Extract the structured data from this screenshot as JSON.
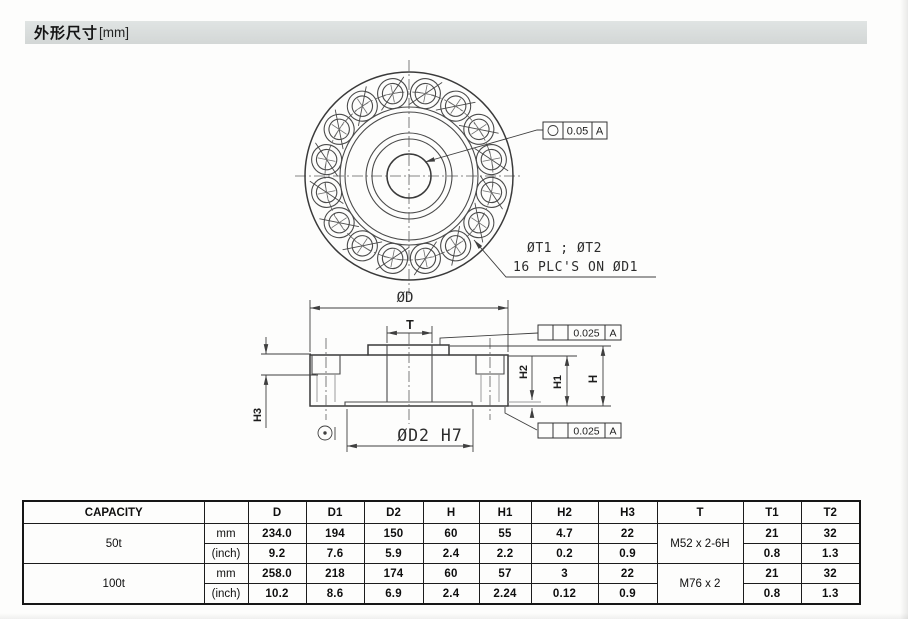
{
  "header": {
    "title": "外形尺寸",
    "unit_suffix": "[mm]"
  },
  "top_view": {
    "tolerance": {
      "symbol": "○",
      "value": "0.05",
      "datum": "A"
    },
    "hole_note_line1": "ØT1 ; ØT2",
    "hole_note_line2": "16 PLC'S ON ØD1"
  },
  "front_view": {
    "labels": {
      "outer_dia": "ØD",
      "thread": "T",
      "h": "H",
      "h1": "H1",
      "h2": "H2",
      "h3": "H3",
      "bore": "ØD2 H7",
      "bore_symbol": "⊙"
    },
    "tolerance_top": {
      "value": "0.025",
      "datum": "A"
    },
    "tolerance_bottom": {
      "value": "0.025",
      "datum": "A"
    }
  },
  "table": {
    "headers": [
      "CAPACITY",
      "",
      "D",
      "D1",
      "D2",
      "H",
      "H1",
      "H2",
      "H3",
      "T",
      "T1",
      "T2"
    ],
    "groups": [
      {
        "capacity": "50t",
        "thread": "M52 x 2-6H",
        "mm": {
          "unit": "mm",
          "D": "234.0",
          "D1": "194",
          "D2": "150",
          "H": "60",
          "H1": "55",
          "H2": "4.7",
          "H3": "22",
          "T1": "21",
          "T2": "32"
        },
        "inch": {
          "unit": "(inch)",
          "D": "9.2",
          "D1": "7.6",
          "D2": "5.9",
          "H": "2.4",
          "H1": "2.2",
          "H2": "0.2",
          "H3": "0.9",
          "T1": "0.8",
          "T2": "1.3"
        }
      },
      {
        "capacity": "100t",
        "thread": "M76 x 2",
        "mm": {
          "unit": "mm",
          "D": "258.0",
          "D1": "218",
          "D2": "174",
          "H": "60",
          "H1": "57",
          "H2": "3",
          "H3": "22",
          "T1": "21",
          "T2": "32"
        },
        "inch": {
          "unit": "(inch)",
          "D": "10.2",
          "D1": "8.6",
          "D2": "6.9",
          "H": "2.4",
          "H1": "2.24",
          "H2": "0.12",
          "H3": "0.9",
          "T1": "0.8",
          "T2": "1.3"
        }
      }
    ]
  }
}
